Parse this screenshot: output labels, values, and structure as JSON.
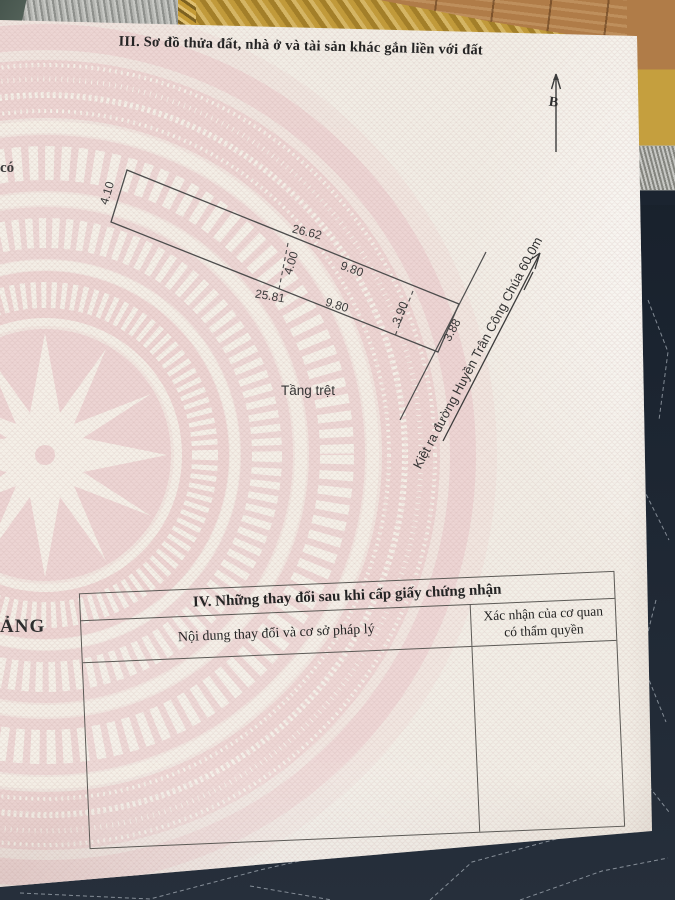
{
  "document": {
    "section3": {
      "title": "III. Sơ đồ thửa đất, nhà ở và tài sản khác gắn liền với đất",
      "north_label": "B",
      "floor_label": "Tầng trệt",
      "alley_label": "Kiệt ra đường Huyền Trân Công Chúa 60.0m",
      "dimensions": {
        "left_edge": "4.10",
        "top_segment_1": "26.62",
        "top_segment_2": "9.80",
        "inner_divider": "4.00",
        "bottom_segment_1": "25.81",
        "bottom_segment_2": "9.80",
        "right_divider": "3.90",
        "street_edge": "3.88"
      }
    },
    "section4": {
      "title": "IV. Những thay đổi sau khi cấp giấy chứng nhận",
      "col_content_header": "Nội dung thay đổi và cơ sở pháp lý",
      "col_confirm_header_line1": "Xác nhận của cơ quan",
      "col_confirm_header_line2": "có thẩm quyền"
    },
    "edge_fragments": {
      "fragment_top": "có",
      "fragment_bottom": "ẢNG"
    }
  },
  "colors": {
    "paper": "#f2eee6",
    "drum_pink": "#ecd0d0",
    "line": "#555555",
    "quilt_navy": "#1c2530",
    "wood": "#b07c48",
    "mat_gold": "#c59f3e"
  }
}
